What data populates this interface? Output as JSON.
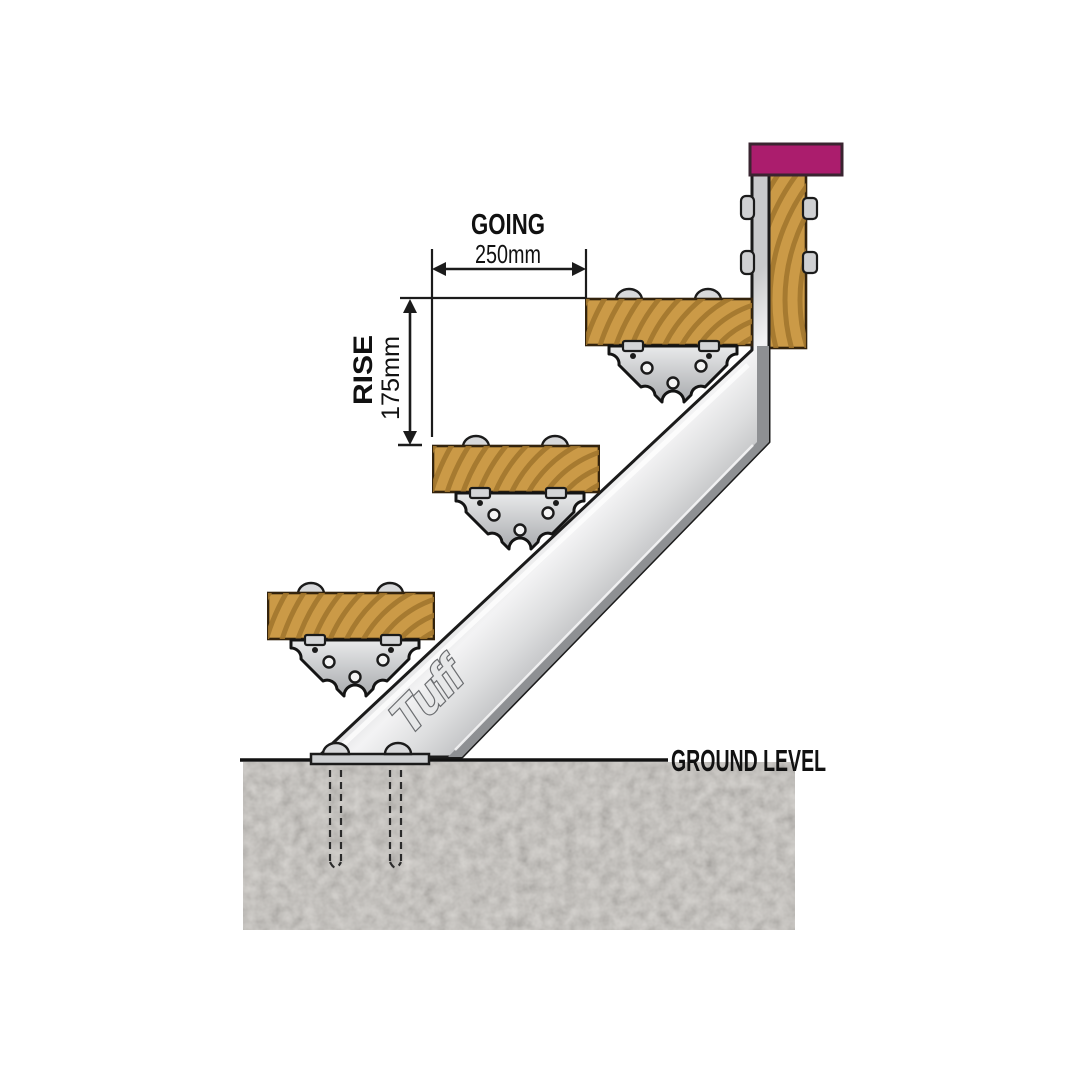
{
  "diagram": {
    "dimensions": {
      "going": {
        "label": "GOING",
        "value": "250mm"
      },
      "rise": {
        "label": "RISE",
        "value": "175mm"
      }
    },
    "ground_label": "GROUND LEVEL",
    "brand_logo": "Tuff",
    "tread_count": 3,
    "colors": {
      "wood": "#cb9a47",
      "wood_grain": "#9f752d",
      "metal_light": "#dadbdd",
      "metal_mid": "#c2c3c6",
      "metal_dark": "#8e9093",
      "outline": "#1b1b1b",
      "cap": "#ab1d6d",
      "concrete": "#c8c4be"
    }
  }
}
